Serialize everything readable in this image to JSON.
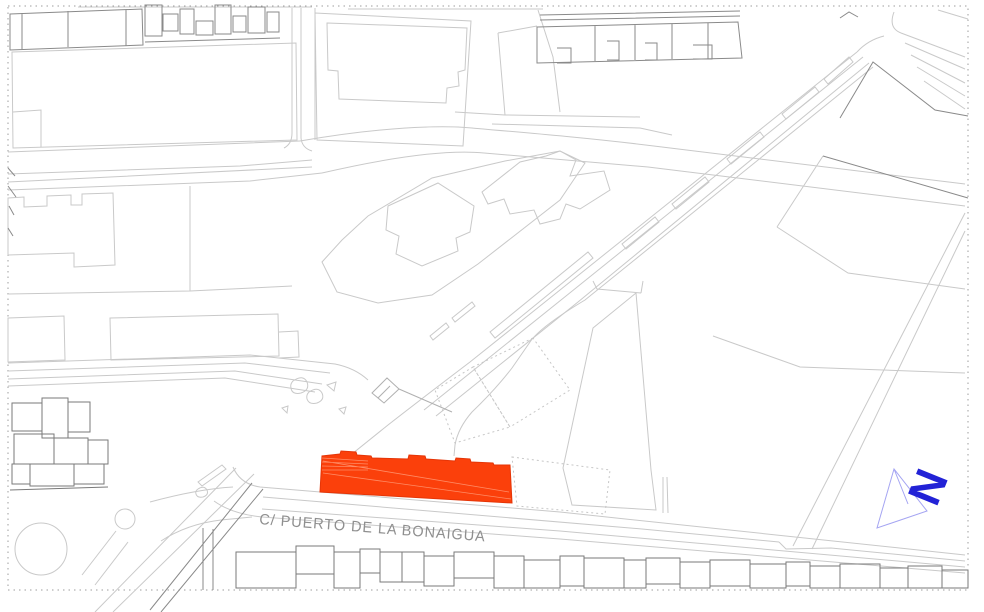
{
  "street": {
    "label": "C/ PUERTO DE LA BONAIGUA"
  },
  "north": {
    "letter": "N"
  },
  "colors": {
    "border_color": "#9e9e9e",
    "line_light": "#c9c9c9",
    "line_lighter": "#d8d8d8",
    "line_mid": "#b0b0b0",
    "line_dark": "#8a8a8a",
    "line_building": "#7a7a7a",
    "line_dotted": "#c6c6c6",
    "highlight_fill": "#FB400B",
    "highlight_stroke": "#E53507",
    "highlight_roof": "#FF8C66",
    "north_color": "#2222D6",
    "north_outline_color": "#a5a5f2",
    "label_color": "#8f8f8f"
  }
}
